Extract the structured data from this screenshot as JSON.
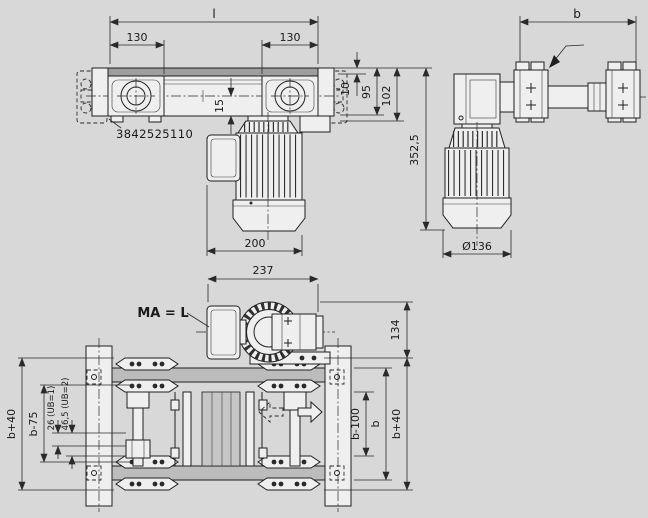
{
  "drawing": {
    "part_number": "3842525110",
    "colors": {
      "background": "#d8d8d8",
      "line": "#1f1f1f",
      "part_fill": "#efefef",
      "belt_shade": "#9e9e9e",
      "rail_shade": "#bcbcbc"
    },
    "side_view": {
      "dim_length": "l",
      "dim_130_left": "130",
      "dim_130_right": "130",
      "dim_15": "15",
      "dim_200": "200",
      "dim_10": "10",
      "dim_95": "95",
      "dim_102": "102",
      "dim_352_5": "352,5"
    },
    "end_view": {
      "dim_b": "b",
      "dim_diameter": "Ø136"
    },
    "plan_view": {
      "torque_label": "MA = L",
      "dim_237": "237",
      "dim_134": "134",
      "dim_b_plus_40_left": "b+40",
      "dim_b_minus_75": "b-75",
      "dim_26_ub1": "26 (UB=1)",
      "dim_46_5_ub2": "46,5 (UB=2)",
      "dim_b_minus_100": "b-100",
      "dim_b": "b",
      "dim_b_plus_40_right": "b+40"
    }
  }
}
